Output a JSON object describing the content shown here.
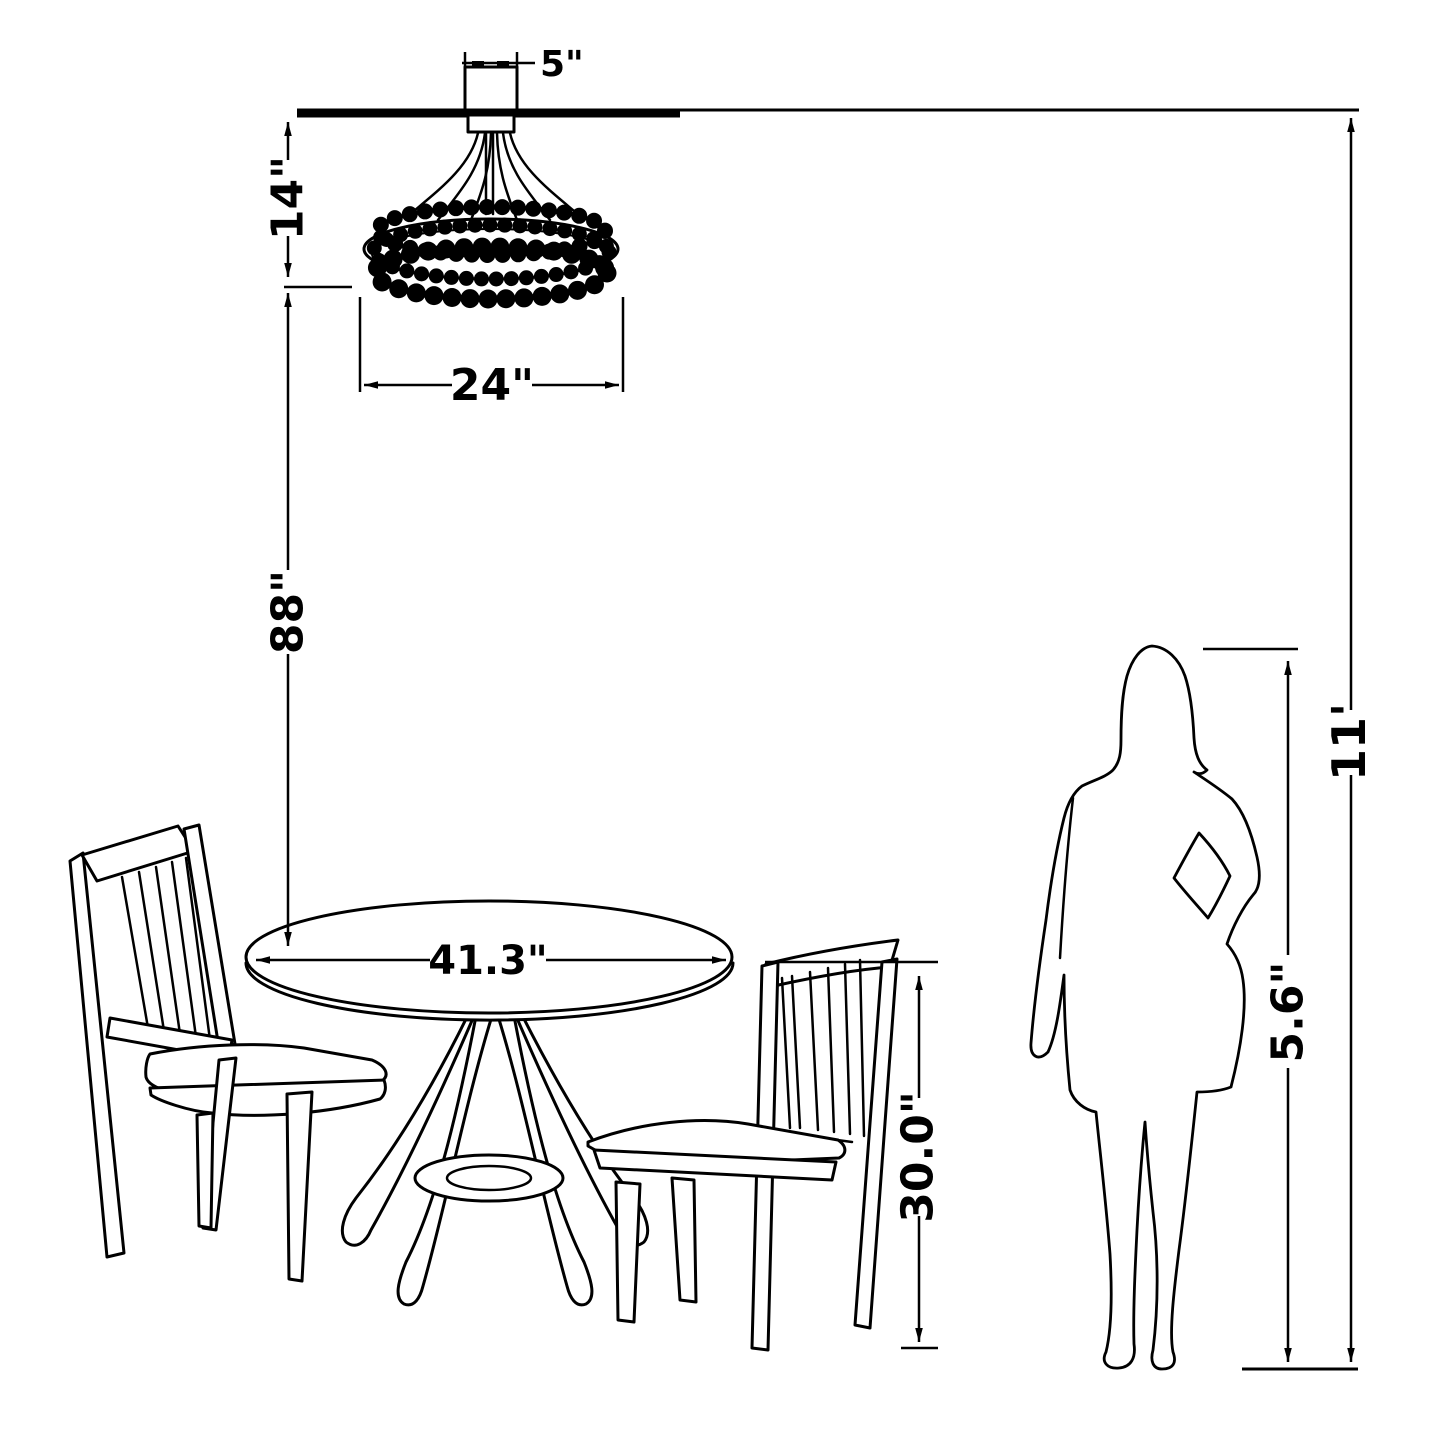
{
  "labels": {
    "canopy_width": "5\"",
    "fixture_height": "14\"",
    "fixture_diameter": "24\"",
    "fixture_to_table": "88\"",
    "table_diameter": "41.3\"",
    "table_height": "30.0\"",
    "person_height": "5.6\"",
    "ceiling_height": "11'"
  },
  "colors": {
    "line": "#000000",
    "background": "#ffffff"
  },
  "objects": {
    "ceiling": "ceiling line",
    "chandelier": "beaded chandelier with ceiling canopy",
    "table": "round pedestal dining table",
    "chair_left": "slat-back dining chair (left)",
    "chair_right": "slat-back dining chair (right)",
    "person": "standing woman silhouette",
    "floor": "floor reference line"
  }
}
